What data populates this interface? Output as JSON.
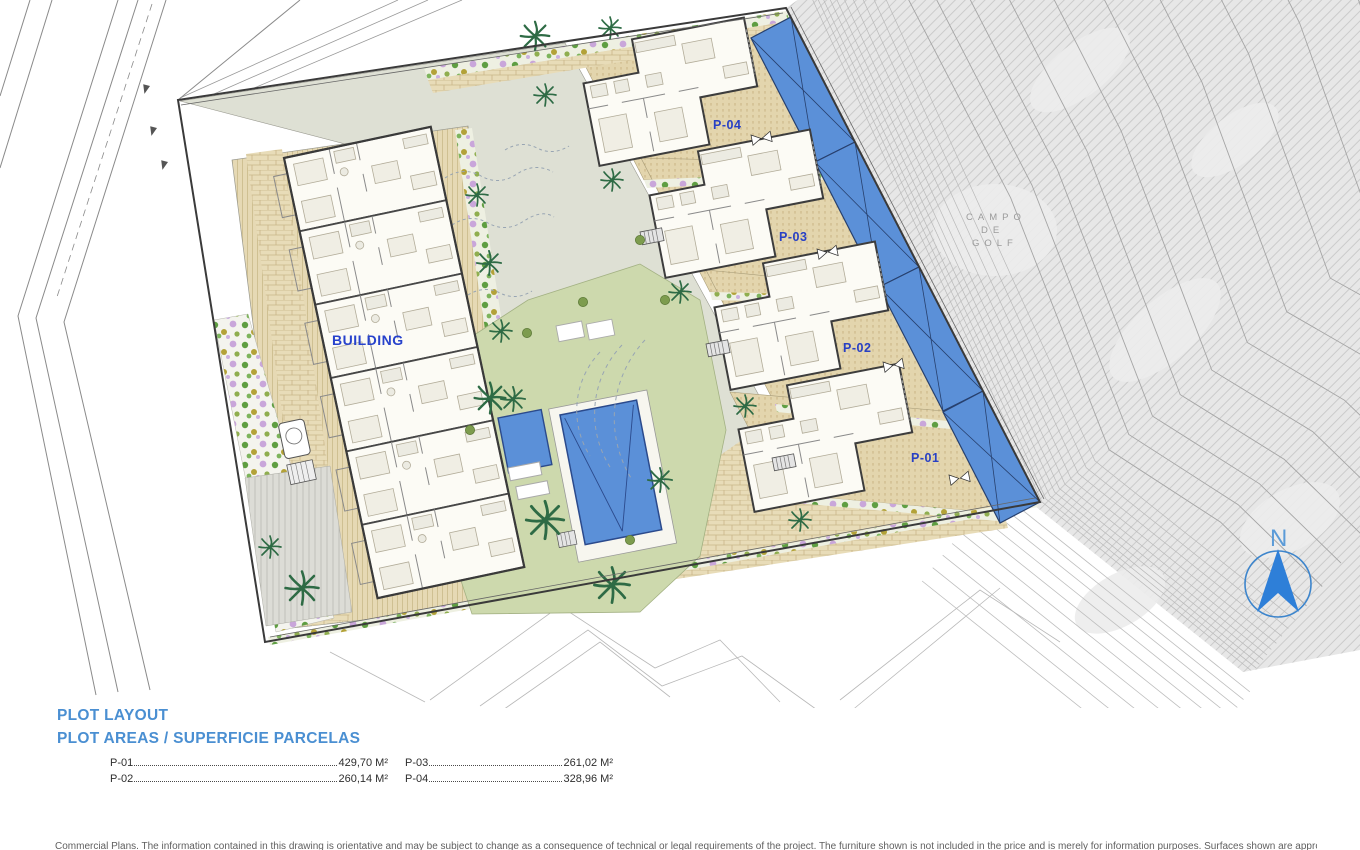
{
  "page": {
    "type": "architectural-site-plan",
    "background": "#ffffff"
  },
  "plan": {
    "building_label": "BUILDING",
    "golf_area_label": [
      "CAMPO",
      "DE",
      "GOLF"
    ],
    "north_indicator": "N",
    "plots": [
      {
        "label": "P-04"
      },
      {
        "label": "P-03"
      },
      {
        "label": "P-02"
      },
      {
        "label": "P-01"
      }
    ]
  },
  "legend": {
    "title": "PLOT LAYOUT",
    "subtitle": "PLOT AREAS / SUPERFICIE PARCELAS",
    "items": [
      {
        "code": "P-01",
        "area": "429,70 M²"
      },
      {
        "code": "P-02",
        "area": "260,14 M²"
      },
      {
        "code": "P-03",
        "area": "261,02 M²"
      },
      {
        "code": "P-04",
        "area": "328,96 M²"
      }
    ]
  },
  "footer": {
    "disclaimer": "Commercial Plans. The information contained in this drawing is orientative and may be subject to change as a consequence of technical or legal requirements of the project. The furniture shown is not included in the price and is merely for information purposes. Surfaces shown are approximate."
  },
  "colors": {
    "heading_blue": "#4a8fd2",
    "label_blue": "#2840c4",
    "pool_blue": "#5b90d8",
    "terrace_tan": "#e3d5ad",
    "lawn_green": "#cdd9ad",
    "golf_gray": "#e7e7e7"
  }
}
